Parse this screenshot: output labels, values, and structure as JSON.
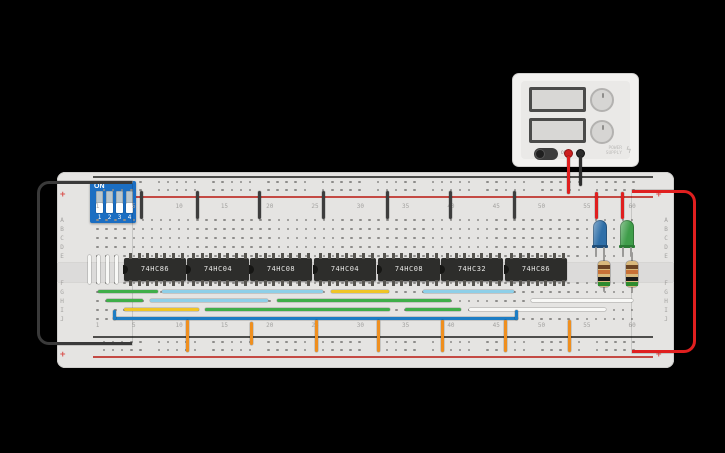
{
  "scene": {
    "background": "#000000"
  },
  "power_supply": {
    "off_label": "OFF",
    "brand_line1": "POWER",
    "brand_line2": "SUPPLY",
    "bolt_icon": "ϟ",
    "terminal_positive_color": "#cc1f1f",
    "terminal_negative_color": "#2c2c2c"
  },
  "dip_switch": {
    "on_label": "ON",
    "positions": [
      "1",
      "2",
      "3",
      "4"
    ]
  },
  "breadboard": {
    "plus": "+",
    "rows_top": [
      "A",
      "B",
      "C",
      "D",
      "E"
    ],
    "rows_bottom": [
      "F",
      "G",
      "H",
      "I",
      "J"
    ],
    "cols": [
      1,
      5,
      10,
      15,
      20,
      25,
      30,
      35,
      40,
      45,
      50,
      55,
      60
    ],
    "rail_positive_color": "#c44a44",
    "rail_negative_color": "#4e4e4c",
    "grid": {
      "x0": 97.6,
      "pitch": 9.06,
      "ncols": 60,
      "rows_top_y": [
        220,
        229,
        238,
        247,
        256
      ],
      "rows_bottom_y": [
        283,
        292,
        301,
        310,
        319
      ],
      "rail_rows_y": [
        182,
        190,
        342,
        350
      ],
      "rail_x0": 104,
      "rail_group_pitch": 54.8,
      "rail_hole_pitch": 9.1,
      "label_top_y": 203,
      "label_bottom_y": 322,
      "letter_left_x": 62,
      "letter_right_x": 666
    }
  },
  "ics": [
    {
      "label": "74HC86",
      "x": 124
    },
    {
      "label": "74HC04",
      "x": 187
    },
    {
      "label": "74HC08",
      "x": 250
    },
    {
      "label": "74HC04",
      "x": 314
    },
    {
      "label": "74HC08",
      "x": 378
    },
    {
      "label": "74HC32",
      "x": 441
    },
    {
      "label": "74HC86",
      "x": 505
    }
  ],
  "leds": [
    {
      "name": "led-blue",
      "x": 593,
      "color": "#2f6fa8",
      "dark": "#1f4d78"
    },
    {
      "name": "led-green",
      "x": 620,
      "color": "#3f9d4a",
      "dark": "#2a7a33"
    }
  ],
  "resistors": [
    {
      "name": "resistor-1",
      "x": 598
    },
    {
      "name": "resistor-2",
      "x": 626
    }
  ],
  "resistor_bands": [
    {
      "y": 4,
      "c": "#6b4423"
    },
    {
      "y": 9,
      "c": "#c87137"
    },
    {
      "y": 16,
      "c": "#1a1a1a"
    },
    {
      "y": 21,
      "c": "#2e8b2e"
    }
  ],
  "wires": [
    {
      "name": "wire-ground-loop-left",
      "x": 37,
      "y": 181,
      "w": 95,
      "h": 164,
      "c": "#3a3a3a",
      "loop": "left"
    },
    {
      "name": "wire-power-loop-right",
      "x": 632,
      "y": 190,
      "w": 64,
      "h": 163,
      "c": "#e01f1f",
      "loop": "right"
    },
    {
      "name": "wire-psu-positive",
      "x": 567,
      "y": 156,
      "w": 3,
      "h": 38,
      "c": "#e01f1f"
    },
    {
      "name": "wire-psu-negative",
      "x": 579,
      "y": 156,
      "w": 3,
      "h": 30,
      "c": "#2e2e2e"
    },
    {
      "name": "wire-vcc-jumper-1",
      "x": 140,
      "y": 191,
      "w": 3,
      "h": 28,
      "c": "#3d3d3d"
    },
    {
      "name": "wire-vcc-jumper-2",
      "x": 196,
      "y": 191,
      "w": 3,
      "h": 28,
      "c": "#3d3d3d"
    },
    {
      "name": "wire-vcc-jumper-3",
      "x": 258,
      "y": 191,
      "w": 3,
      "h": 28,
      "c": "#3d3d3d"
    },
    {
      "name": "wire-vcc-jumper-4",
      "x": 322,
      "y": 191,
      "w": 3,
      "h": 28,
      "c": "#3d3d3d"
    },
    {
      "name": "wire-vcc-jumper-5",
      "x": 386,
      "y": 191,
      "w": 3,
      "h": 28,
      "c": "#3d3d3d"
    },
    {
      "name": "wire-vcc-jumper-6",
      "x": 449,
      "y": 191,
      "w": 3,
      "h": 28,
      "c": "#3d3d3d"
    },
    {
      "name": "wire-vcc-jumper-7",
      "x": 513,
      "y": 191,
      "w": 3,
      "h": 28,
      "c": "#3d3d3d"
    },
    {
      "name": "wire-led-blue-power",
      "x": 595,
      "y": 192,
      "w": 3,
      "h": 27,
      "c": "#e01f1f"
    },
    {
      "name": "wire-led-green-power",
      "x": 621,
      "y": 192,
      "w": 3,
      "h": 27,
      "c": "#e01f1f"
    },
    {
      "name": "wire-dip-1",
      "x": 88,
      "y": 255,
      "w": 3,
      "h": 29,
      "c": "#f8f8f6"
    },
    {
      "name": "wire-dip-2",
      "x": 97,
      "y": 255,
      "w": 3,
      "h": 29,
      "c": "#f8f8f6"
    },
    {
      "name": "wire-dip-3",
      "x": 106,
      "y": 255,
      "w": 3,
      "h": 29,
      "c": "#f8f8f6"
    },
    {
      "name": "wire-dip-4",
      "x": 115,
      "y": 255,
      "w": 3,
      "h": 29,
      "c": "#f8f8f6"
    },
    {
      "name": "wire-g-green-1",
      "x": 98,
      "y": 290,
      "w": 60,
      "h": 3,
      "c": "#3fae49"
    },
    {
      "name": "wire-g-cyan-1",
      "x": 162,
      "y": 290,
      "w": 161,
      "h": 3,
      "c": "#8ecfe8"
    },
    {
      "name": "wire-g-yellow",
      "x": 331,
      "y": 290,
      "w": 58,
      "h": 3,
      "c": "#f0c526"
    },
    {
      "name": "wire-g-cyan-2",
      "x": 423,
      "y": 290,
      "w": 91,
      "h": 3,
      "c": "#8ecfe8"
    },
    {
      "name": "wire-h-green-1",
      "x": 106,
      "y": 299,
      "w": 37,
      "h": 3,
      "c": "#3fae49"
    },
    {
      "name": "wire-h-cyan",
      "x": 150,
      "y": 299,
      "w": 118,
      "h": 3,
      "c": "#8ecfe8"
    },
    {
      "name": "wire-h-green-2",
      "x": 277,
      "y": 299,
      "w": 174,
      "h": 3,
      "c": "#3fae49"
    },
    {
      "name": "wire-h-white",
      "x": 531,
      "y": 299,
      "w": 102,
      "h": 3,
      "c": "#f8f8f6"
    },
    {
      "name": "wire-i-yellow",
      "x": 124,
      "y": 308,
      "w": 75,
      "h": 3,
      "c": "#f0c526"
    },
    {
      "name": "wire-i-green-1",
      "x": 205,
      "y": 308,
      "w": 185,
      "h": 3,
      "c": "#3fae49"
    },
    {
      "name": "wire-i-green-2",
      "x": 405,
      "y": 308,
      "w": 56,
      "h": 3,
      "c": "#3fae49"
    },
    {
      "name": "wire-i-white",
      "x": 469,
      "y": 308,
      "w": 137,
      "h": 3,
      "c": "#f8f8f6"
    },
    {
      "name": "wire-j-blue",
      "x": 113,
      "y": 317,
      "w": 405,
      "h": 3,
      "c": "#1d7dc4"
    },
    {
      "name": "wire-j-blue-hook-left",
      "x": 113,
      "y": 310,
      "w": 3,
      "h": 10,
      "c": "#1d7dc4"
    },
    {
      "name": "wire-j-blue-hook-right",
      "x": 515,
      "y": 310,
      "w": 3,
      "h": 10,
      "c": "#1d7dc4"
    },
    {
      "name": "wire-ground-drop-1",
      "x": 186,
      "y": 320,
      "w": 3,
      "h": 32,
      "c": "#ef8f1f"
    },
    {
      "name": "wire-ground-drop-2",
      "x": 250,
      "y": 322,
      "w": 3,
      "h": 23,
      "c": "#ef8f1f"
    },
    {
      "name": "wire-ground-drop-3",
      "x": 315,
      "y": 320,
      "w": 3,
      "h": 32,
      "c": "#ef8f1f"
    },
    {
      "name": "wire-ground-drop-4",
      "x": 377,
      "y": 320,
      "w": 3,
      "h": 32,
      "c": "#ef8f1f"
    },
    {
      "name": "wire-ground-drop-5",
      "x": 441,
      "y": 320,
      "w": 3,
      "h": 32,
      "c": "#ef8f1f"
    },
    {
      "name": "wire-ground-drop-6",
      "x": 504,
      "y": 320,
      "w": 3,
      "h": 32,
      "c": "#ef8f1f"
    },
    {
      "name": "wire-ground-drop-7",
      "x": 568,
      "y": 320,
      "w": 3,
      "h": 32,
      "c": "#ef8f1f"
    }
  ]
}
